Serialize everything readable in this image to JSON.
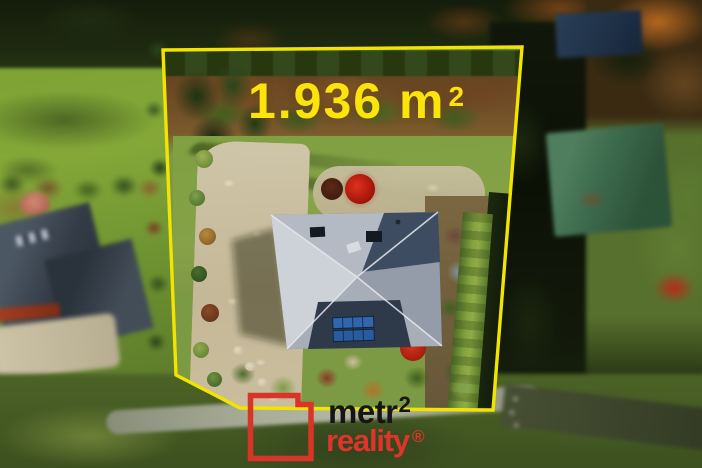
{
  "watermark": {
    "area_value": "1.936 m",
    "area_superscript": "2",
    "area_full_text": "1.936 m²",
    "text_color": "#fbe40a"
  },
  "boundary": {
    "stroke_color": "#f2e400"
  },
  "logo": {
    "word_top": "metr",
    "word_top_superscript": "2",
    "word_bottom": "reality",
    "registered_symbol": "®",
    "square_color": "#d93428",
    "word_top_color": "#151515",
    "word_bottom_color": "#dd352c"
  }
}
